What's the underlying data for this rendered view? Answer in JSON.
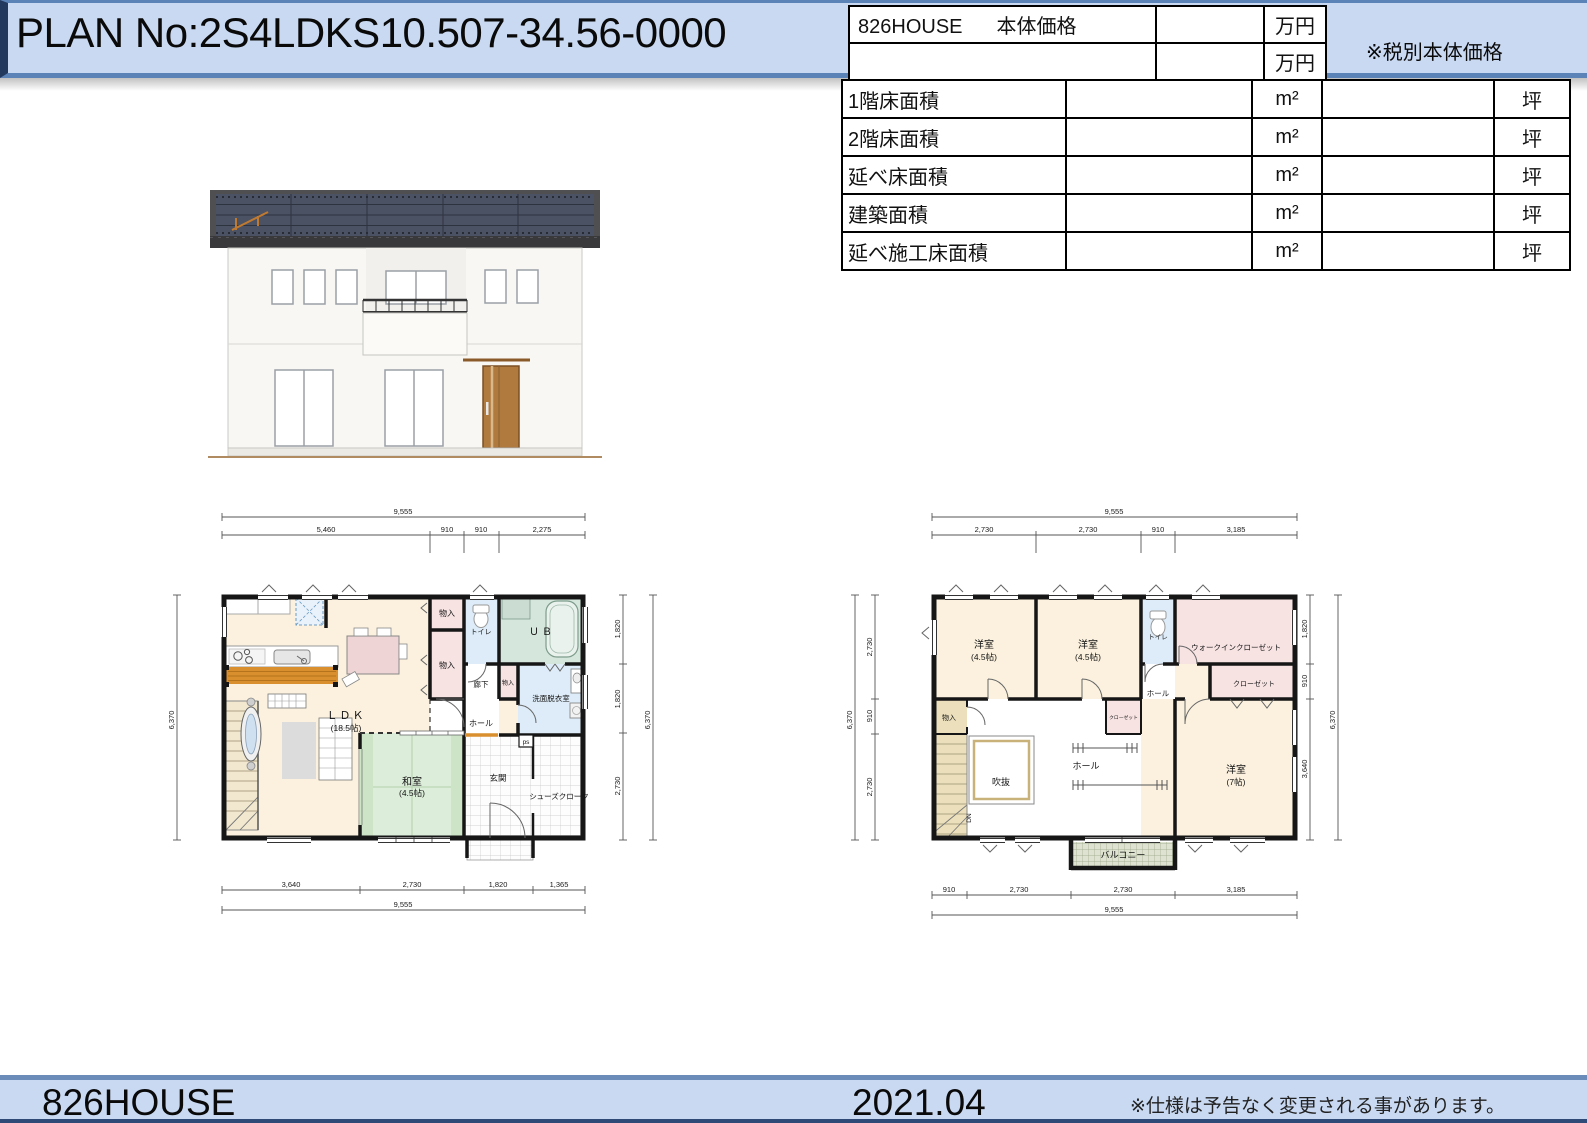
{
  "colors": {
    "banner_fill": "#c9d9f2",
    "banner_border": "#5b83b8",
    "banner_edge_dark": "#24395e",
    "roof_panel": "#4b5264",
    "door_wood": "#b07a3f",
    "tatami_green": "#dcedda",
    "closet_pink": "#f8e3e3",
    "wet_area_blue": "#ddecf8",
    "bath_teal": "#d5e6dd",
    "counter_orange": "#d98f2e"
  },
  "header": {
    "plan_no": "PLAN No:2S4LDKS10.507-34.56-0000",
    "tax_note": "※税別本体価格"
  },
  "price_table": {
    "brand": "826HOUSE",
    "label": "本体価格",
    "rows": [
      {
        "value": "",
        "unit": "万円"
      },
      {
        "value": "",
        "unit": "万円"
      }
    ]
  },
  "area_table": {
    "rows": [
      {
        "label": "1階床面積",
        "value1": "",
        "unit1": "m²",
        "value2": "",
        "unit2": "坪"
      },
      {
        "label": "2階床面積",
        "value1": "",
        "unit1": "m²",
        "value2": "",
        "unit2": "坪"
      },
      {
        "label": "延べ床面積",
        "value1": "",
        "unit1": "m²",
        "value2": "",
        "unit2": "坪"
      },
      {
        "label": "建築面積",
        "value1": "",
        "unit1": "m²",
        "value2": "",
        "unit2": "坪"
      },
      {
        "label": "延べ施工床面積",
        "value1": "",
        "unit1": "m²",
        "value2": "",
        "unit2": "坪"
      }
    ]
  },
  "floor1": {
    "dims": {
      "top_total": "9,555",
      "top": [
        "5,460",
        "910",
        "910",
        "2,275"
      ],
      "left_total": "6,370",
      "right": [
        "1,820",
        "1,820",
        "2,730"
      ],
      "right_total": "6,370",
      "bottom": [
        "3,640",
        "2,730",
        "1,820",
        "1,365"
      ],
      "bottom_total": "9,555"
    },
    "labels": {
      "ldk": "ＬＤＫ",
      "ldk_size": "(18.5帖)",
      "washitsu": "和室",
      "washitsu_size": "(4.5帖)",
      "storage1": "物入",
      "storage2": "物入",
      "storage3": "物入",
      "toilet": "トイレ",
      "bath": "ＵＢ",
      "corridor": "廊下",
      "washroom": "洗面脱衣室",
      "hall": "ホール",
      "entrance": "玄関",
      "shoe_closet": "シューズクローク",
      "ps": "ps"
    }
  },
  "floor2": {
    "dims": {
      "top_total": "9,555",
      "top": [
        "2,730",
        "2,730",
        "910",
        "3,185"
      ],
      "left": [
        "2,730",
        "910",
        "2,730"
      ],
      "left_total": "6,370",
      "right": [
        "1,820",
        "910",
        "3,640"
      ],
      "right_total": "6,370",
      "bottom": [
        "910",
        "2,730",
        "2,730",
        "3,185"
      ],
      "bottom_total": "9,555"
    },
    "labels": {
      "bedroom1": "洋室",
      "bedroom1_size": "(4.5帖)",
      "bedroom2": "洋室",
      "bedroom2_size": "(4.5帖)",
      "toilet": "トイレ",
      "wic": "ウォークインクローゼット",
      "closet1": "クローゼット",
      "closet2": "クローゼット",
      "hall_upper": "ホール",
      "hall": "ホール",
      "storage": "物入",
      "void": "吹抜",
      "dn": "DN",
      "bedroom3": "洋室",
      "bedroom3_size": "(7帖)",
      "balcony": "バルコニー"
    }
  },
  "footer": {
    "brand": "826HOUSE",
    "date": "2021.04",
    "note": "※仕様は予告なく変更される事があります。"
  }
}
